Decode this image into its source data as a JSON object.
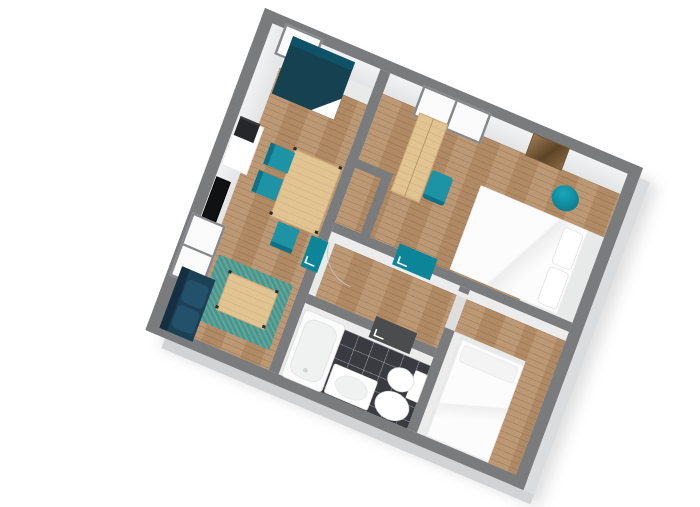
{
  "scene": {
    "description": "3D isometric floor plan render of a two-room apartment, no visible text",
    "palette": {
      "background": "#ffffff",
      "wall": "#7a7b7d",
      "floor": "#e8e9e9",
      "outer_face_se": "#dbdcdd",
      "outer_face_sw": "#d2d3d4",
      "niche_floor": "#f6f6f7",
      "wood": "#b8926b",
      "wood_light": "#e2c493",
      "teal": "#1e93a6",
      "teal_dark": "#0e7287",
      "door_teal": "#0d8599",
      "door_dark": "#4b4c4e",
      "rug": "#4f9d93",
      "sofa": "#1c4156",
      "sofa_cushion": "#23506a",
      "sofa_back": "#152f41",
      "bed_teal": "#154151",
      "bed_teal_head": "#0d5266",
      "tile": "#3a3b40",
      "tv": "#0f1113",
      "printer": "#26272b",
      "white": "#ffffff",
      "fixture_inner": "#f0f1f1",
      "picture_brown": "#87684a",
      "shadow": "#9a9a9a"
    },
    "rooms": [
      {
        "name": "living-dining-room",
        "floor": "wood",
        "items": [
          "teal-single-bed",
          "white-desk-cabinet",
          "printer",
          "dining-table",
          "dining-chair",
          "dining-chair",
          "dining-chair",
          "wall-mounted-tv",
          "teal-area-rug",
          "coffee-table",
          "navy-sofa"
        ],
        "windows": [
          "single-window-north-east",
          "double-window-north-west"
        ]
      },
      {
        "name": "bedroom",
        "floor": "wood",
        "items": [
          "white-double-bed",
          "pillow",
          "pillow",
          "wardrobe",
          "desk-chair",
          "round-armchair",
          "wall-picture"
        ],
        "windows": [
          "double-window-north-east"
        ]
      },
      {
        "name": "hallway",
        "floor": "wood",
        "items": [
          "teal-door-living-room",
          "teal-door-bedroom",
          "dark-door-bathroom",
          "door-swing-arc"
        ]
      },
      {
        "name": "bathroom",
        "floor": "black-tiles",
        "items": [
          "bathtub",
          "toilet",
          "bidet",
          "washbasin"
        ]
      },
      {
        "name": "small-bedroom",
        "floor": "wood-and-grey",
        "items": [
          "white-bed"
        ]
      },
      {
        "name": "closet-niche",
        "floor": "white",
        "items": []
      }
    ]
  }
}
